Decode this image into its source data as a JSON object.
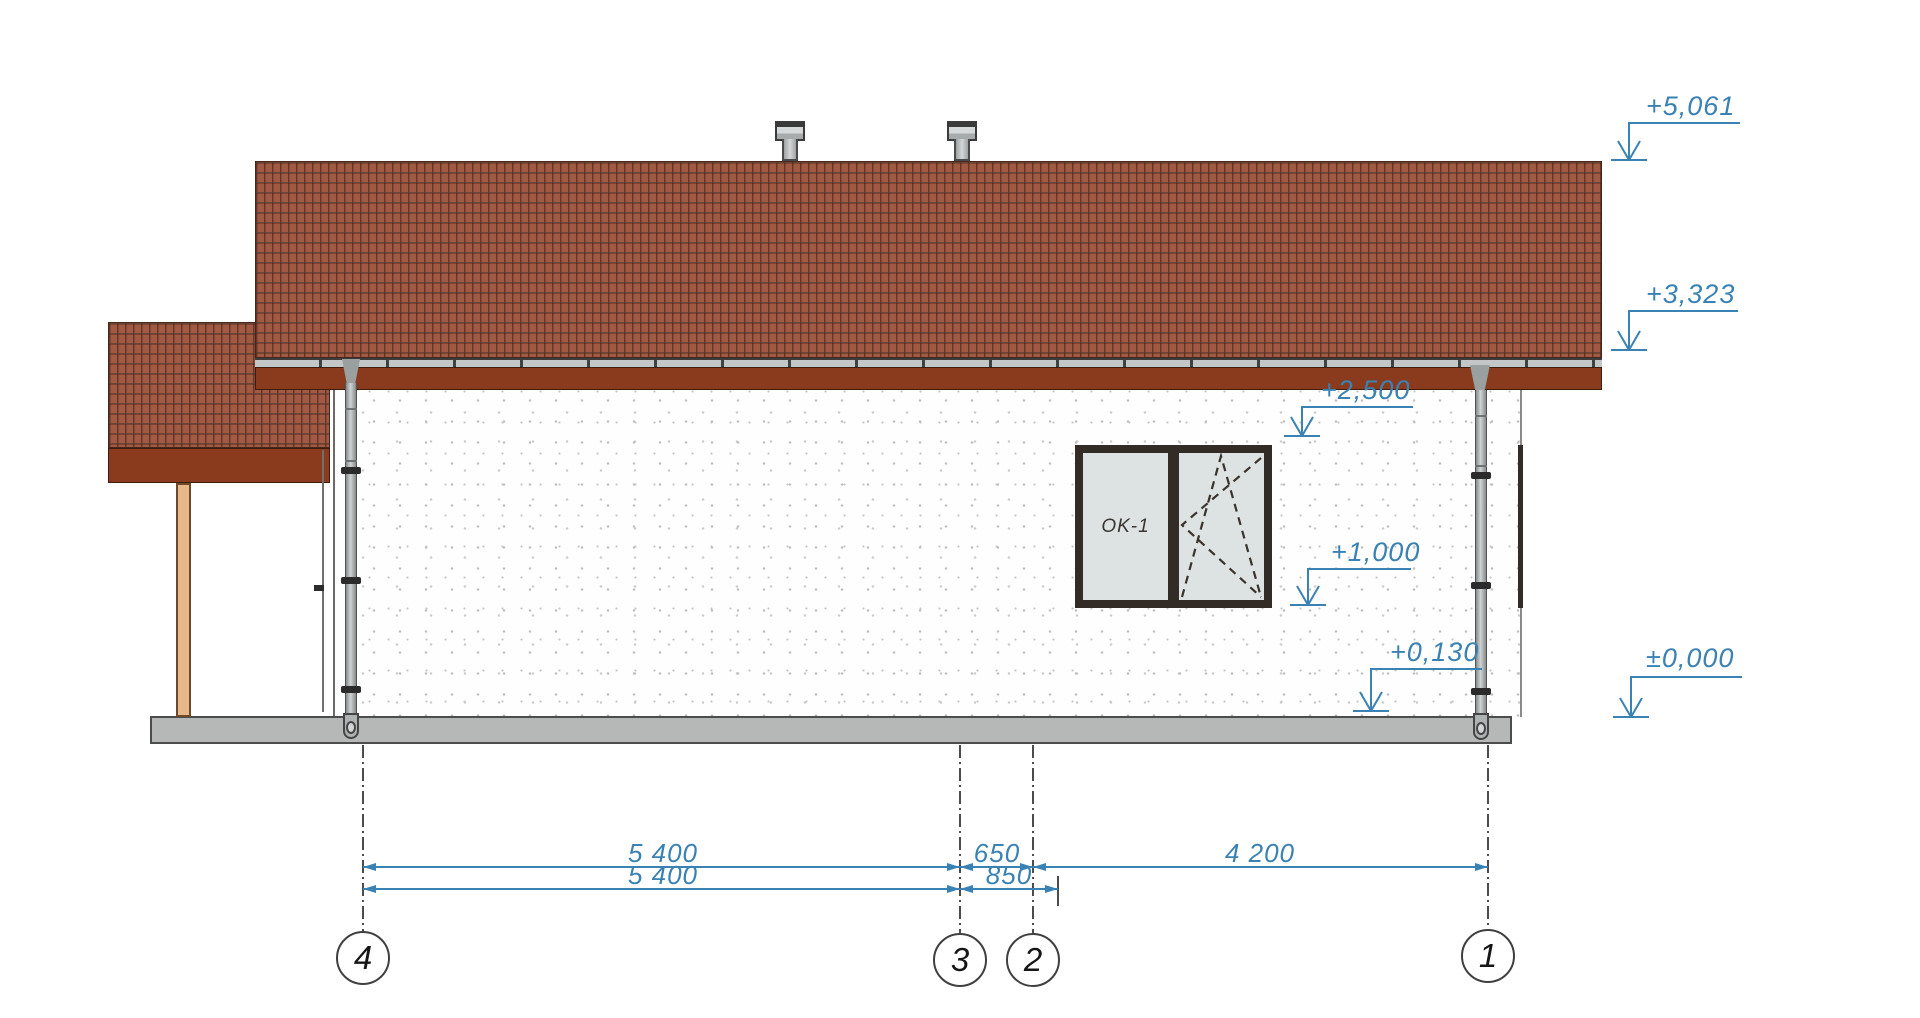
{
  "drawing": {
    "title": "house-side-elevation",
    "elevation_markers": [
      {
        "id": "ridge",
        "label": "+5,061"
      },
      {
        "id": "eave",
        "label": "+3,323"
      },
      {
        "id": "wall-top",
        "label": "+2,500"
      },
      {
        "id": "window-sill",
        "label": "+1,000"
      },
      {
        "id": "plinth-top",
        "label": "+0,130"
      },
      {
        "id": "ground",
        "label": "±0,000"
      }
    ],
    "dimensions": {
      "row1": [
        {
          "label": "5 400"
        },
        {
          "label": "650"
        },
        {
          "label": "4 200"
        }
      ],
      "row2": [
        {
          "label": "5 400"
        },
        {
          "label": "850"
        }
      ]
    },
    "axes": [
      {
        "label": "4"
      },
      {
        "label": "3"
      },
      {
        "label": "2"
      },
      {
        "label": "1"
      }
    ],
    "window": {
      "label": "OK-1"
    },
    "colors": {
      "annotation_blue": "#3b82b4",
      "roof_tile": "#a05a44",
      "fascia_brown": "#8a3a1d",
      "wall_white": "#fdfdfd",
      "plinth_gray": "#b6b7b7",
      "post_wood": "#e8b88b",
      "frame_dark": "#332c26"
    }
  }
}
